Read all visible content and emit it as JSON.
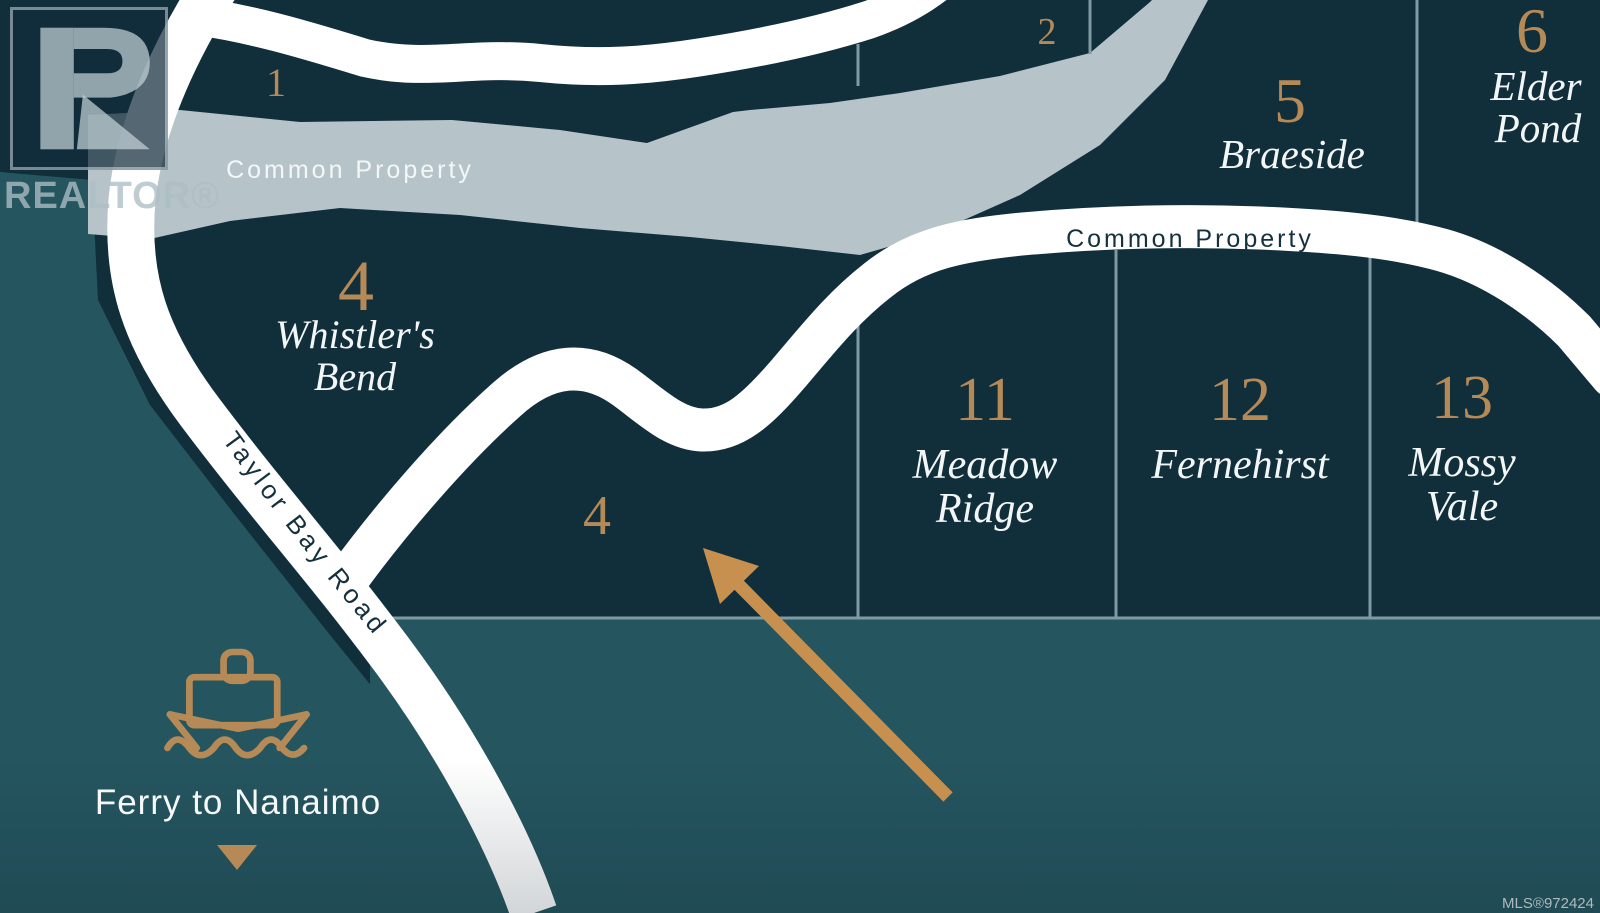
{
  "map": {
    "watermark": {
      "logo_text": "REALTOR®"
    },
    "labels": {
      "stream_common_property": "Common Property",
      "road_common_property": "Common Property",
      "taylor_bay_road": "Taylor Bay Road",
      "ferry": "Ferry to Nanaimo",
      "mls": "MLS®972424"
    },
    "lots": {
      "lot1": {
        "number": "1"
      },
      "lot2": {
        "number": "2"
      },
      "lot4": {
        "number": "4",
        "line1": "Whistler's",
        "line2": "Bend"
      },
      "lot4b": {
        "number": "4"
      },
      "lot5": {
        "number": "5",
        "name": "Braeside"
      },
      "lot6": {
        "number": "6",
        "line1": "Elder",
        "line2": "Pond"
      },
      "lot11": {
        "number": "11",
        "line1": "Meadow",
        "line2": "Ridge"
      },
      "lot12": {
        "number": "12",
        "name": "Fernehirst"
      },
      "lot13": {
        "number": "13",
        "line1": "Mossy",
        "line2": "Vale"
      }
    },
    "colors": {
      "lot_dark": "#112e3b",
      "outside_light": "#25555f",
      "stream": "#b6c4c9",
      "road": "#ffffff",
      "gold": "#b58a57",
      "arrow": "#c8904f",
      "boundary_line": "#7f9aa3"
    }
  }
}
